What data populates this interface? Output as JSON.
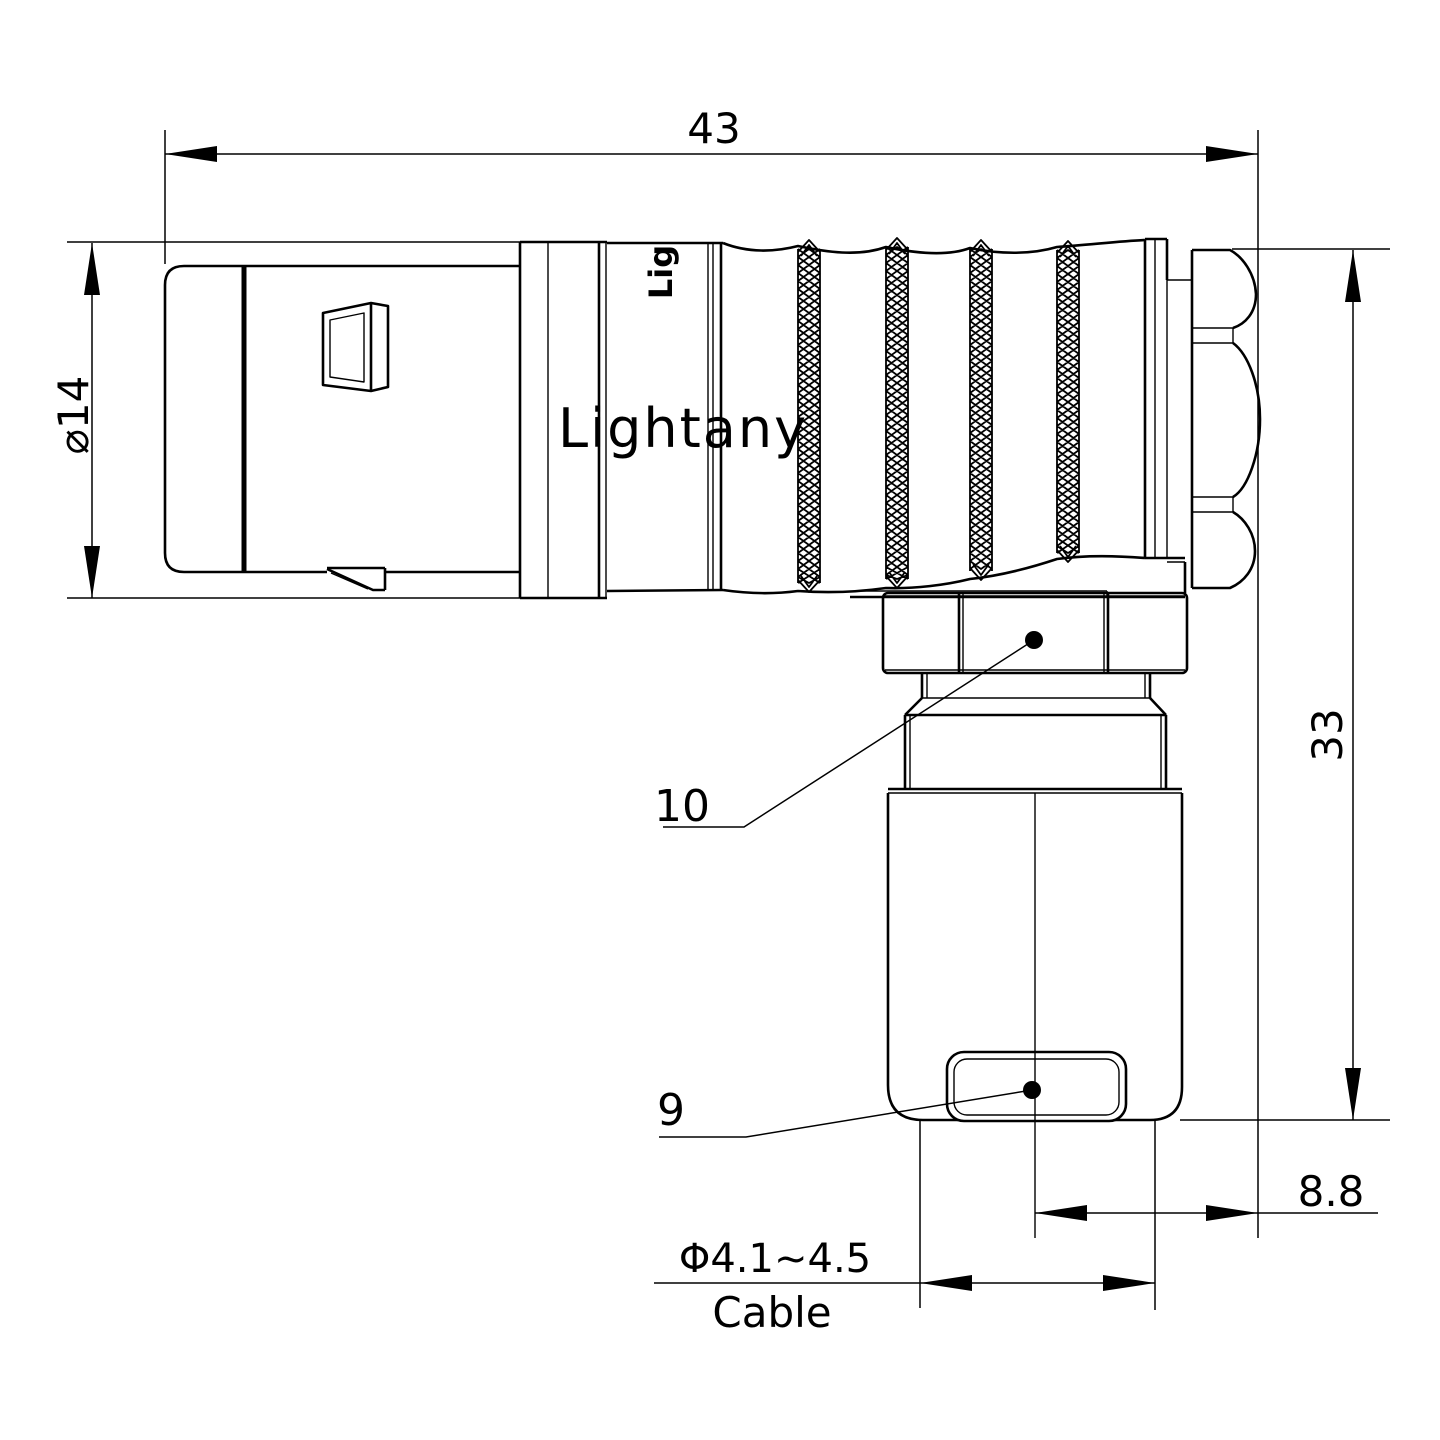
{
  "colors": {
    "line": "#000000",
    "watermark": "#f2b9b9",
    "engraving": "#000000"
  },
  "watermark": {
    "text": "Lightany"
  },
  "engraving": {
    "text": "Lig"
  },
  "dimensions": {
    "overall_length": {
      "value": "43"
    },
    "front_diameter": {
      "value": "⌀14"
    },
    "height": {
      "value": "33"
    },
    "nut_to_edge": {
      "value": "8.8"
    },
    "cable": {
      "diameter_range": "Φ4.1~4.5",
      "label": "Cable"
    }
  },
  "part_labels": {
    "coupling_nut": "10",
    "cable_clamp": "9"
  }
}
